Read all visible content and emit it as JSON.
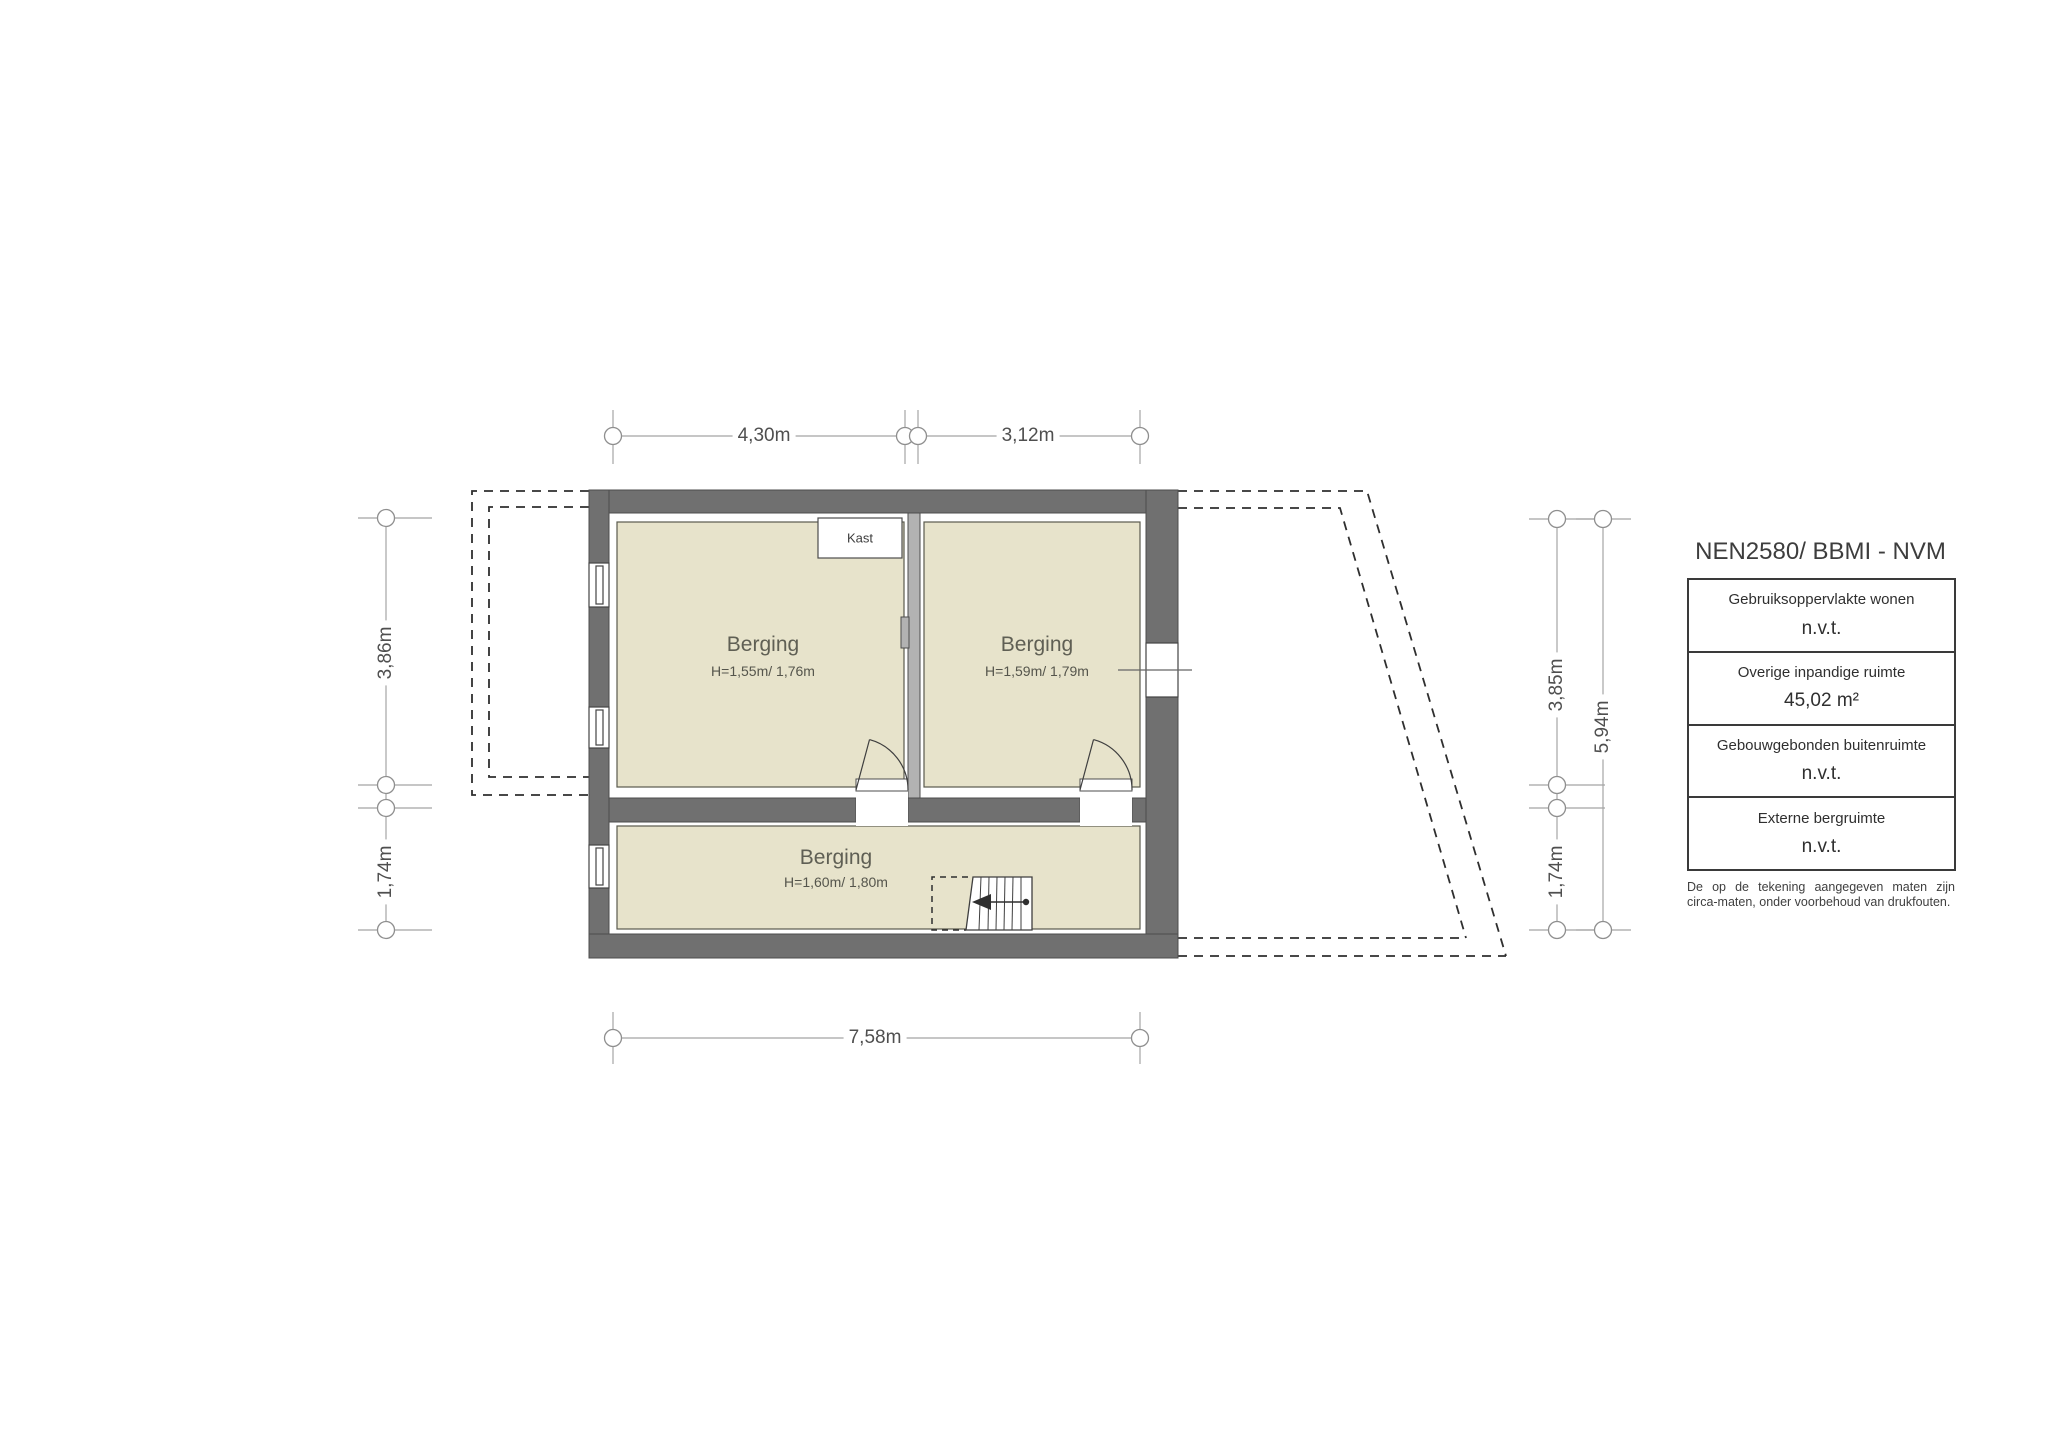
{
  "plan": {
    "rooms": [
      {
        "name": "Berging",
        "height_note": "H=1,55m/ 1,76m"
      },
      {
        "name": "Berging",
        "height_note": "H=1,59m/ 1,79m"
      },
      {
        "name": "Berging",
        "height_note": "H=1,60m/ 1,80m"
      }
    ],
    "closet_label": "Kast",
    "dimensions": {
      "top": [
        "4,30m",
        "3,12m"
      ],
      "bottom": [
        "7,58m"
      ],
      "left": [
        "3,86m",
        "1,74m"
      ],
      "right_inner": [
        "3,85m",
        "1,74m"
      ],
      "right_outer": [
        "5,94m"
      ]
    },
    "colors": {
      "wall": "#707070",
      "light_wall": "#b2b2b2",
      "floor": "#e7e3cb",
      "dimension_line": "#a5a5a5"
    }
  },
  "legend": {
    "title": "NEN2580/ BBMI - NVM",
    "rows": [
      {
        "label": "Gebruiksoppervlakte wonen",
        "value": "n.v.t."
      },
      {
        "label": "Overige inpandige ruimte",
        "value": "45,02 m²"
      },
      {
        "label": "Gebouwgebonden buitenruimte",
        "value": "n.v.t."
      },
      {
        "label": "Externe bergruimte",
        "value": "n.v.t."
      }
    ],
    "disclaimer_line1": "De op de tekening aangegeven maten zijn",
    "disclaimer_line2": "circa-maten, onder voorbehoud van drukfouten."
  }
}
